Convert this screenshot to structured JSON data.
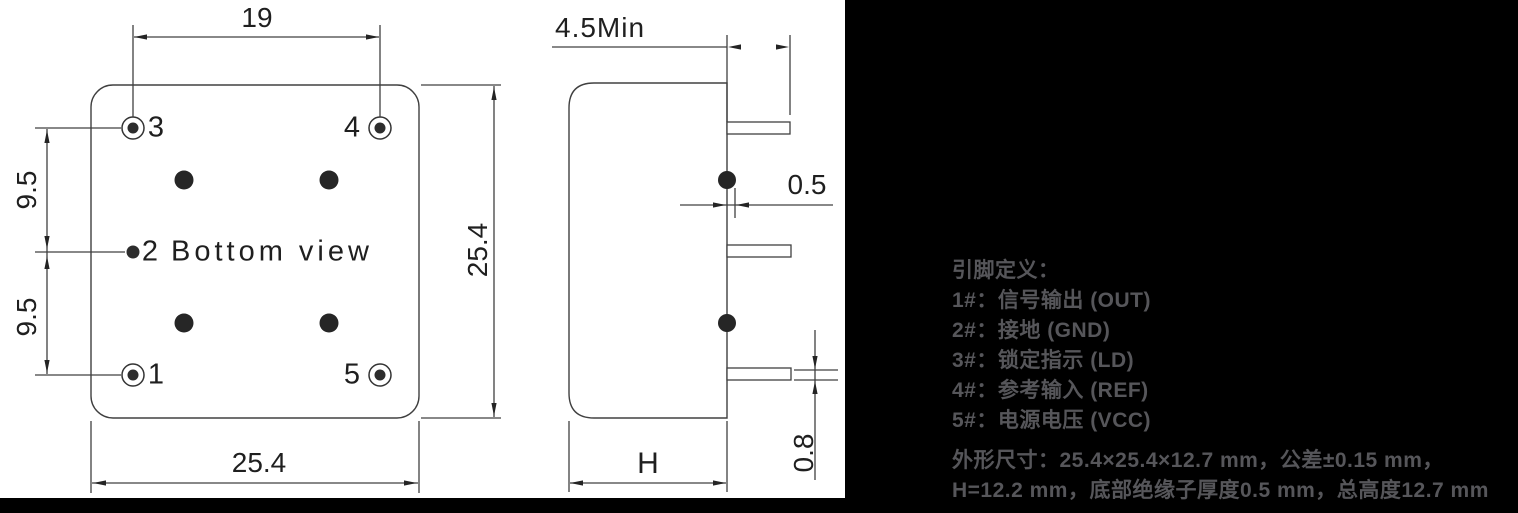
{
  "bottom_view": {
    "title": "Bottom view",
    "pin_labels": {
      "pin1": "1",
      "pin2": "2",
      "pin3": "3",
      "pin4": "4",
      "pin5": "5"
    },
    "dimensions": {
      "pin_span_horizontal": "19",
      "pin_pitch_upper": "9.5",
      "pin_pitch_lower": "9.5",
      "body_height": "25.4",
      "body_width": "25.4"
    }
  },
  "side_view": {
    "dimensions": {
      "lead_length_min": "4.5Min",
      "insulator_offset": "0.5",
      "lead_diameter": "0.8",
      "body_thickness": "H"
    }
  },
  "info_panel": {
    "background_color": "#000000",
    "text_color": "#56565a",
    "pin_definition_title": "引脚定义：",
    "pin_definitions": [
      "1#：信号输出 (OUT)",
      "2#：接地 (GND)",
      "3#：锁定指示 (LD)",
      "4#：参考输入 (REF)",
      "5#：电源电压 (VCC)"
    ],
    "outline_note_line1": "外形尺寸：25.4×25.4×12.7 mm，公差±0.15 mm，",
    "outline_note_line2": "H=12.2 mm，底部绝缘子厚度0.5 mm，总高度12.7 mm"
  },
  "drawing": {
    "line_color": "#404040",
    "ink_color": "#242424"
  }
}
